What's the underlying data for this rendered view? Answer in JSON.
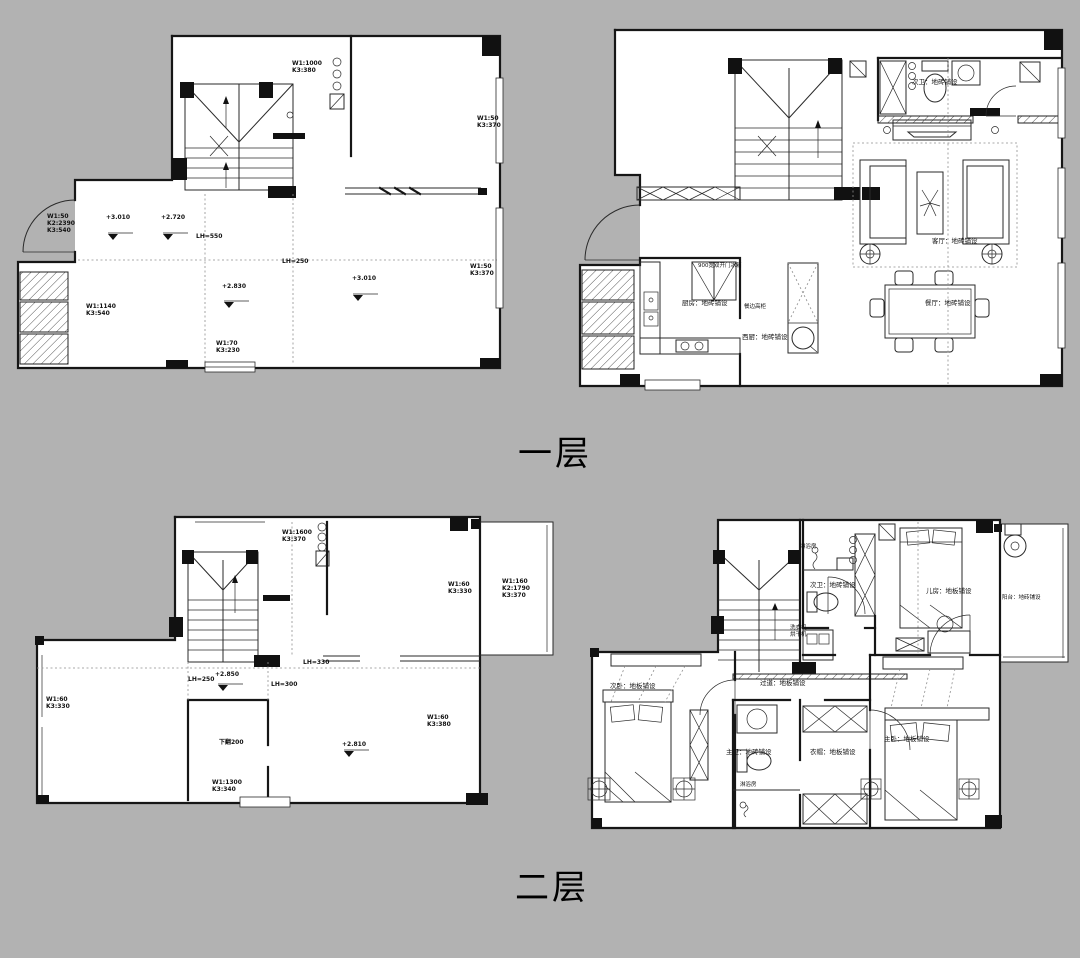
{
  "page": {
    "background": "#b2b2b2",
    "ink": "#111111",
    "caption_floor1": "一层",
    "caption_floor2": "二层"
  },
  "floor1_structural": {
    "t1": "W1:1000\nK3:380",
    "t2": "W1:50\nK3:370",
    "t3": "W1:50\nK2:2390\nK3:540",
    "t4": "+3.010",
    "t5": "+2.720",
    "t6": "LH=550",
    "t7": "LH=250",
    "t8": "+2.830",
    "t9": "+3.010",
    "t10": "W1:1140\nK3:540",
    "t11": "W1:70\nK3:230",
    "t12": "W1:50\nK3:370"
  },
  "floor1_furnished": {
    "bath": "次卫：地砖铺设",
    "living": "客厅：地砖铺设",
    "dining": "餐厅：地砖铺设",
    "kitchen": "厨房：地砖铺设",
    "fridge": "900宽双开门冰箱",
    "tall_cabinet": "餐边高柜",
    "west_kitchen": "西厨：地砖铺设"
  },
  "floor2_structural": {
    "t1": "W1:1600\nK3:370",
    "t2": "W1:60\nK3:330",
    "t3": "W1:160\nK2:1790\nK3:370",
    "t4": "W1:60\nK3:330",
    "t5": "LH=330",
    "t6": "LH=250",
    "t7": "+2.850",
    "t8": "LH=300",
    "t9": "下翻200",
    "t10": "+2.810",
    "t11": "W1:60\nK3:380",
    "t12": "W1:1300\nK3:340"
  },
  "floor2_furnished": {
    "shower1": "淋浴房",
    "bath2": "次卫：地砖铺设",
    "washer": "洗衣机\n烘干机",
    "kid": "儿房：地板铺设",
    "balcony": "阳台：地砖铺设",
    "bed2": "次卧：地板铺设",
    "hall": "过道：地板铺设",
    "master_bath": "主卫：地砖铺设",
    "cloak": "衣帽：地板铺设",
    "master": "主卧：地板铺设",
    "shower2": "淋浴房"
  }
}
